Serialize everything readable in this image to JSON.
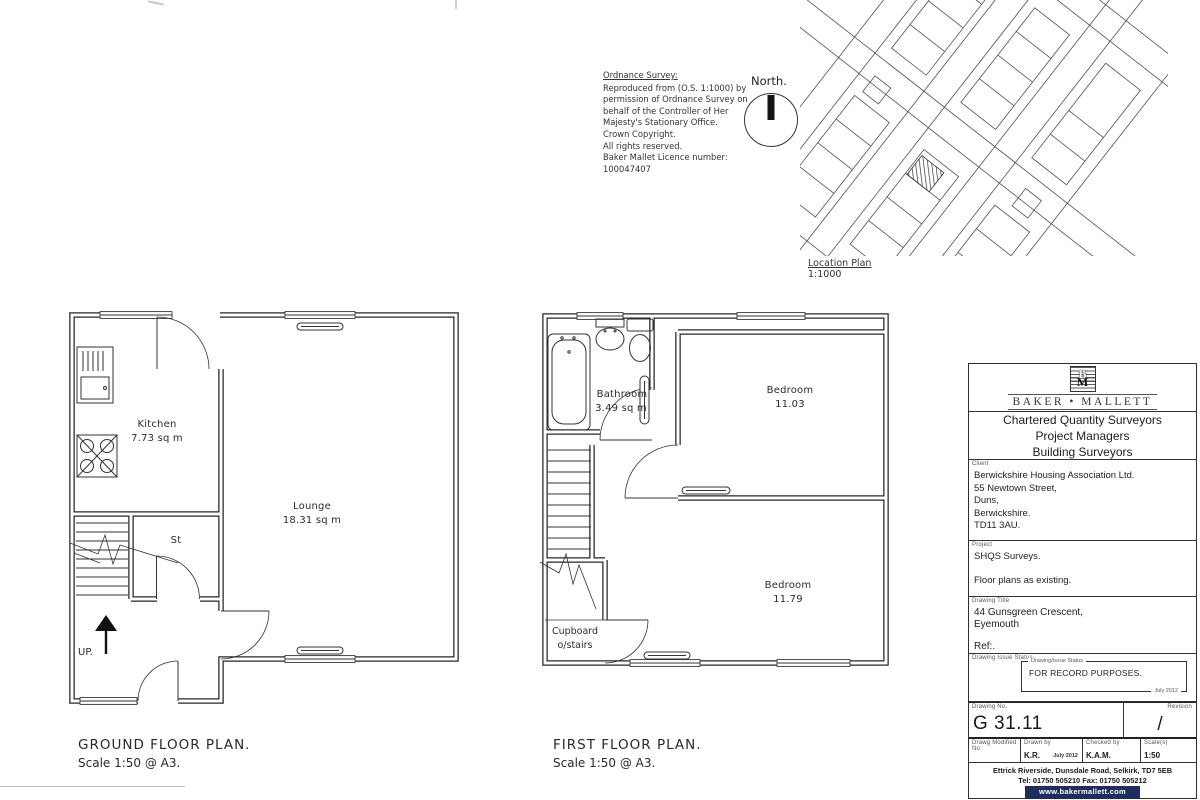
{
  "os_note": {
    "title": "Ordnance Survey:",
    "lines": [
      "Reproduced from (O.S. 1:1000) by",
      "permission of Ordnance Survey on",
      "behalf of the Controller of Her",
      "Majesty's Stationary Office.",
      "Crown Copyright.",
      "All rights reserved.",
      "Baker Mallet Licence number:",
      "100047407"
    ]
  },
  "north": {
    "label": "North."
  },
  "location_plan": {
    "caption": "Location Plan",
    "scale": "1:1000"
  },
  "ground_floor": {
    "caption": "GROUND FLOOR  PLAN.",
    "scale_note": "Scale 1:50 @ A3.",
    "kitchen_name": "Kitchen",
    "kitchen_area": "7.73  sq  m",
    "lounge_name": "Lounge",
    "lounge_area": "18.31  sq  m",
    "store": "St",
    "up": "UP."
  },
  "first_floor": {
    "caption": "FIRST FLOOR  PLAN.",
    "scale_note": "Scale 1:50 @ A3.",
    "bathroom_name": "Bathroom",
    "bathroom_area": "3.49  sq  m",
    "bedroom1_name": "Bedroom",
    "bedroom1_area": "11.03",
    "bedroom2_name": "Bedroom",
    "bedroom2_area": "11.79",
    "cupboard_line1": "Cupboard",
    "cupboard_line2": "o/stairs"
  },
  "title_block": {
    "logo_top": "B",
    "logo_bottom": "M",
    "brand": "BAKER • MALLETT",
    "services": [
      "Chartered Quantity Surveyors",
      "Project Managers",
      "Building Surveyors"
    ],
    "client_label": "Client",
    "client_lines": [
      "Berwickshire Housing Association Ltd.",
      "55 Newtown Street,",
      "Duns,",
      "Berwickshire.",
      "TD11 3AU."
    ],
    "project_label": "Project",
    "project_line1": "SHQS Surveys.",
    "project_line2": "Floor plans as existing.",
    "drawing_title_label": "Drawing Title",
    "drawing_title_line1": "44 Gunsgreen Crescent,",
    "drawing_title_line2": "Eyemouth",
    "ref": "Ref:.",
    "issue_label": "Drawing Issue Status",
    "issue_box_label": "Drawing/Issue Status",
    "issue_text": "FOR RECORD PURPOSES.",
    "issue_date": "July 2012",
    "drawing_no_label": "Drawing No.",
    "drawing_no": "G 31.11",
    "revision_label": "Revision",
    "revision": "/",
    "modified_label": "Drawg Modified No",
    "drawn_label": "Drawn by",
    "drawn_by": "K.R.",
    "drawn_date": "July 2012",
    "checked_label": "Checked by",
    "checked_by": "K.A.M.",
    "scale_label": "Scale(s)",
    "scale_value": "1:50",
    "footer_address": "Ettrick Riverside, Dunsdale Road, Selkirk, TD7 5EB",
    "footer_telfax": "Tel:  01750 505210    Fax:  01750 505212",
    "footer_web": "www.bakermallett.com"
  }
}
